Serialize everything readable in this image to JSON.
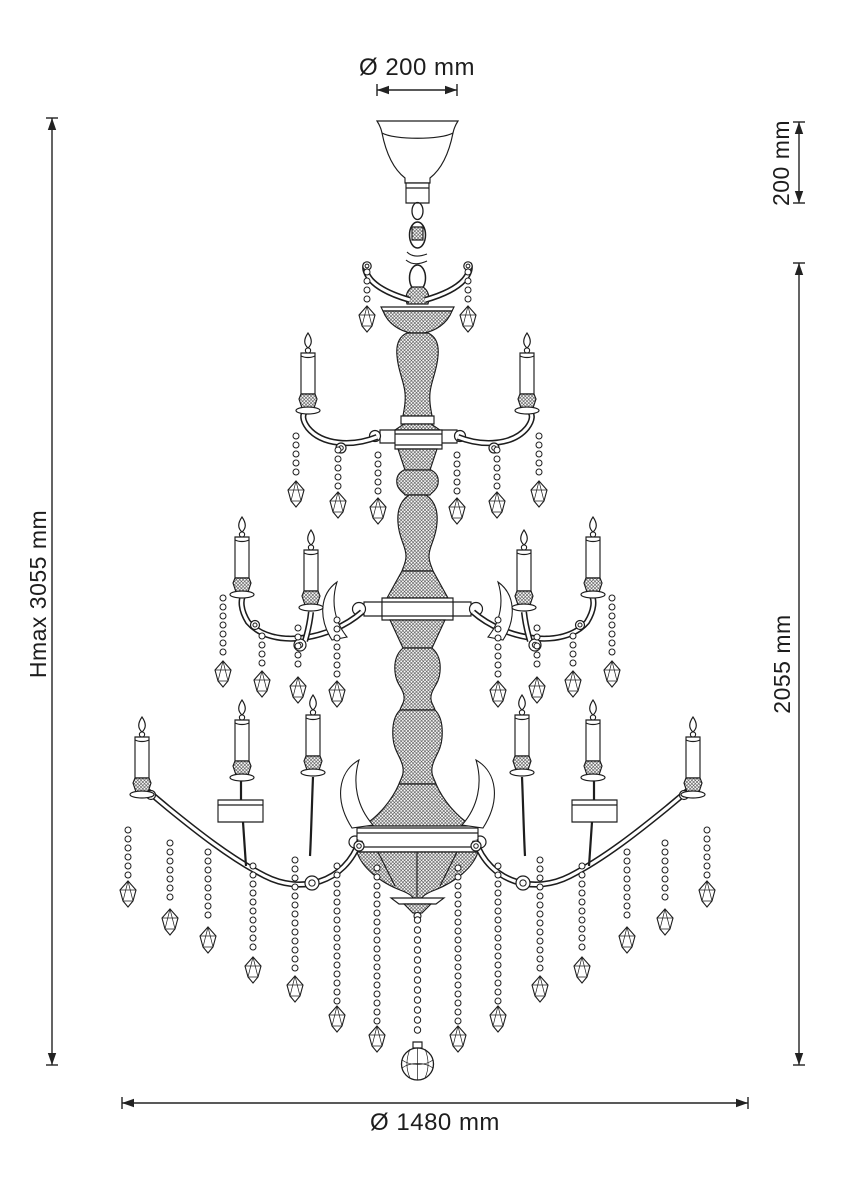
{
  "colors": {
    "background": "#ffffff",
    "line": "#1d1d1d",
    "dimension": "#222222"
  },
  "dimension_labels": {
    "top_diameter": "Ø 200 mm",
    "suspension_height": "200 mm",
    "fixture_height": "2055 mm",
    "max_height": "Hmax 3055 mm",
    "bottom_diameter": "Ø 1480 mm"
  }
}
